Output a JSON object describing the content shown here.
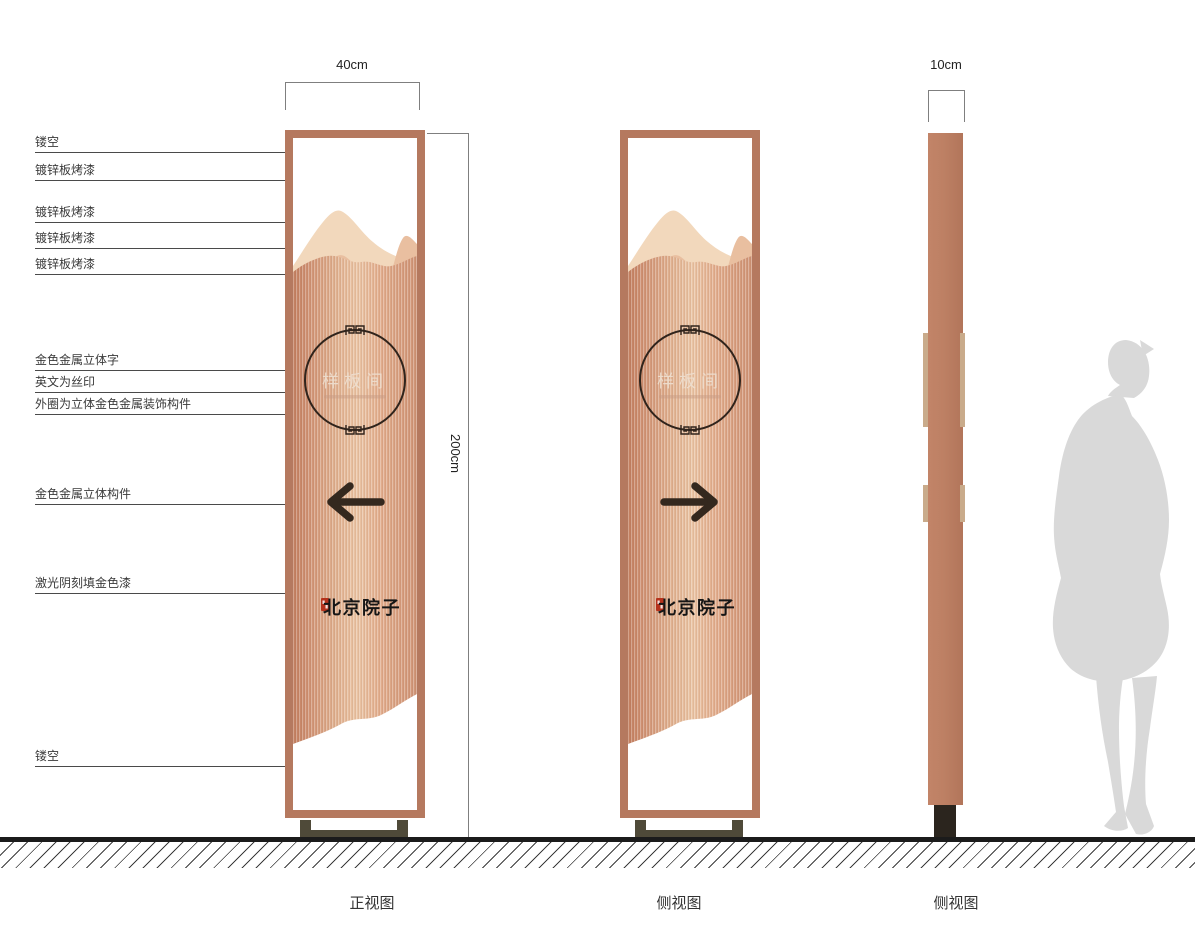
{
  "annotations": [
    {
      "label": "镂空"
    },
    {
      "label": "镀锌板烤漆"
    },
    {
      "label": "镀锌板烤漆"
    },
    {
      "label": "镀锌板烤漆"
    },
    {
      "label": "镀锌板烤漆"
    },
    {
      "label": "金色金属立体字"
    },
    {
      "label": "英文为丝印"
    },
    {
      "label": "外圈为立体金色金属装饰构件"
    },
    {
      "label": "金色金属立体构件"
    },
    {
      "label": "激光阴刻填金色漆"
    },
    {
      "label": "镂空"
    }
  ],
  "dimensions": {
    "width": "40cm",
    "height": "200cm",
    "depth": "10cm"
  },
  "signage": {
    "room_label": "样板间",
    "brand": "北京院子",
    "front_arrow_direction": "left",
    "second_arrow_direction": "right"
  },
  "views": [
    {
      "label": "正视图"
    },
    {
      "label": "侧视图"
    },
    {
      "label": "侧视图"
    }
  ],
  "icons": {
    "circle_ornament": "fret-pattern-icon",
    "seal": "red-seal-stamp-icon"
  },
  "colors": {
    "frame": "#b5795f",
    "panel_dark": "#c27f60",
    "panel_light": "#eac4a4",
    "mountain_light": "#f2d8bc",
    "mountain_mid": "#e9bfa0",
    "circle_stroke": "#30241c",
    "arrow": "#34281e",
    "seal_red": "#b5321c",
    "base": "#4f4a39",
    "side_strip": "#c9ab8b",
    "silhouette": "#d9d9d9"
  }
}
